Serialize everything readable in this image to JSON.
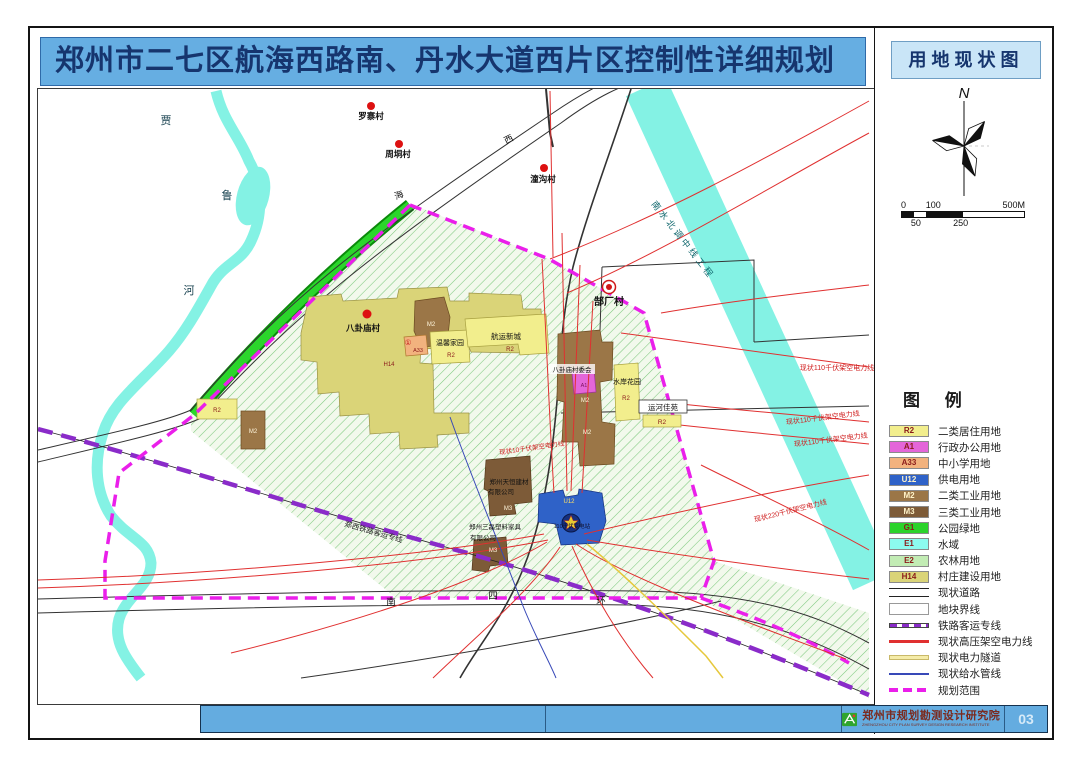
{
  "title": "郑州市二七区航海西路南、丹水大道西片区控制性详细规划",
  "side_panel": {
    "map_type": "用地现状图",
    "compass_north": "N",
    "scale": {
      "top": [
        "0",
        "100",
        "500M"
      ],
      "bottom": [
        "50",
        "250"
      ]
    },
    "legend": {
      "title": "图 例",
      "items": [
        {
          "code": "R2",
          "label": "二类居住用地"
        },
        {
          "code": "A1",
          "label": "行政办公用地"
        },
        {
          "code": "A33",
          "label": "中小学用地"
        },
        {
          "code": "U12",
          "label": "供电用地"
        },
        {
          "code": "M2",
          "label": "二类工业用地"
        },
        {
          "code": "M3",
          "label": "三类工业用地"
        },
        {
          "code": "G1",
          "label": "公园绿地"
        },
        {
          "code": "E1",
          "label": "水域"
        },
        {
          "code": "E2",
          "label": "农林用地"
        },
        {
          "code": "H14",
          "label": "村庄建设用地"
        },
        {
          "code": "",
          "label": "现状道路"
        },
        {
          "code": "",
          "label": "地块界线"
        },
        {
          "code": "",
          "label": "铁路客运专线"
        },
        {
          "code": "",
          "label": "现状高压架空电力线"
        },
        {
          "code": "",
          "label": "现状电力隧道"
        },
        {
          "code": "",
          "label": "现状给水管线"
        },
        {
          "code": "",
          "label": "规划范围"
        }
      ]
    }
  },
  "footer": {
    "institute": "郑州市规划勘测设计研究院",
    "institute_sub": "ZHENGZHOU CITY PLAN SURVEY DESIGN RESEARCH INSTITUTE",
    "page": "03"
  },
  "map": {
    "villages": [
      {
        "name": "罗寨村"
      },
      {
        "name": "周垌村"
      },
      {
        "name": "潼沟村"
      },
      {
        "name": "郜厂村"
      },
      {
        "name": "八卦庙村"
      }
    ],
    "river_chars": [
      "贾",
      "鲁",
      "河"
    ],
    "road_south_chars": [
      "南",
      "四",
      "环"
    ],
    "road_top_chars": [
      "海",
      "西"
    ],
    "water_project": "南水北调中线工程",
    "railway": "郑西铁路客运专线",
    "power": {
      "hv110": "现状110千伏架空电力线",
      "hv220": "现状220千伏架空电力线",
      "hv10": "现状10千伏架空电力线"
    },
    "estates": {
      "wenxin": "温馨家园",
      "hangyun": "航运新城",
      "shuian": "水岸花园",
      "yunhe": "运河佳苑",
      "committee": "八卦庙村委会",
      "substation": "110千伏变电站",
      "tianheng1": "郑州天恒建材",
      "tianheng2": "有限公司",
      "sanlei1": "郑州三磊塑料家具",
      "sanlei2": "有限公司"
    },
    "codes": {
      "r2": "R2",
      "a1": "A1",
      "a33": "A33",
      "u12": "U12",
      "m2": "M2",
      "m3": "M3",
      "h14": "H14",
      "circle1": "①"
    }
  },
  "colors": {
    "R2": "#F2EE8D",
    "A1": "#E466D9",
    "A33": "#F2B27E",
    "U12": "#2F62C8",
    "M2": "#9B7647",
    "M3": "#7D5B38",
    "G1": "#2BD32B",
    "E1": "#8CFBEF",
    "E2": "#C2ECB4",
    "H14": "#DAD478",
    "power_line": "#E03030",
    "railway": "#8A2BC9",
    "boundary": "#EA1FEA",
    "water_line": "#3849B8",
    "power_tunnel": "#E6C83C",
    "title_bar": "#66AEE2"
  }
}
